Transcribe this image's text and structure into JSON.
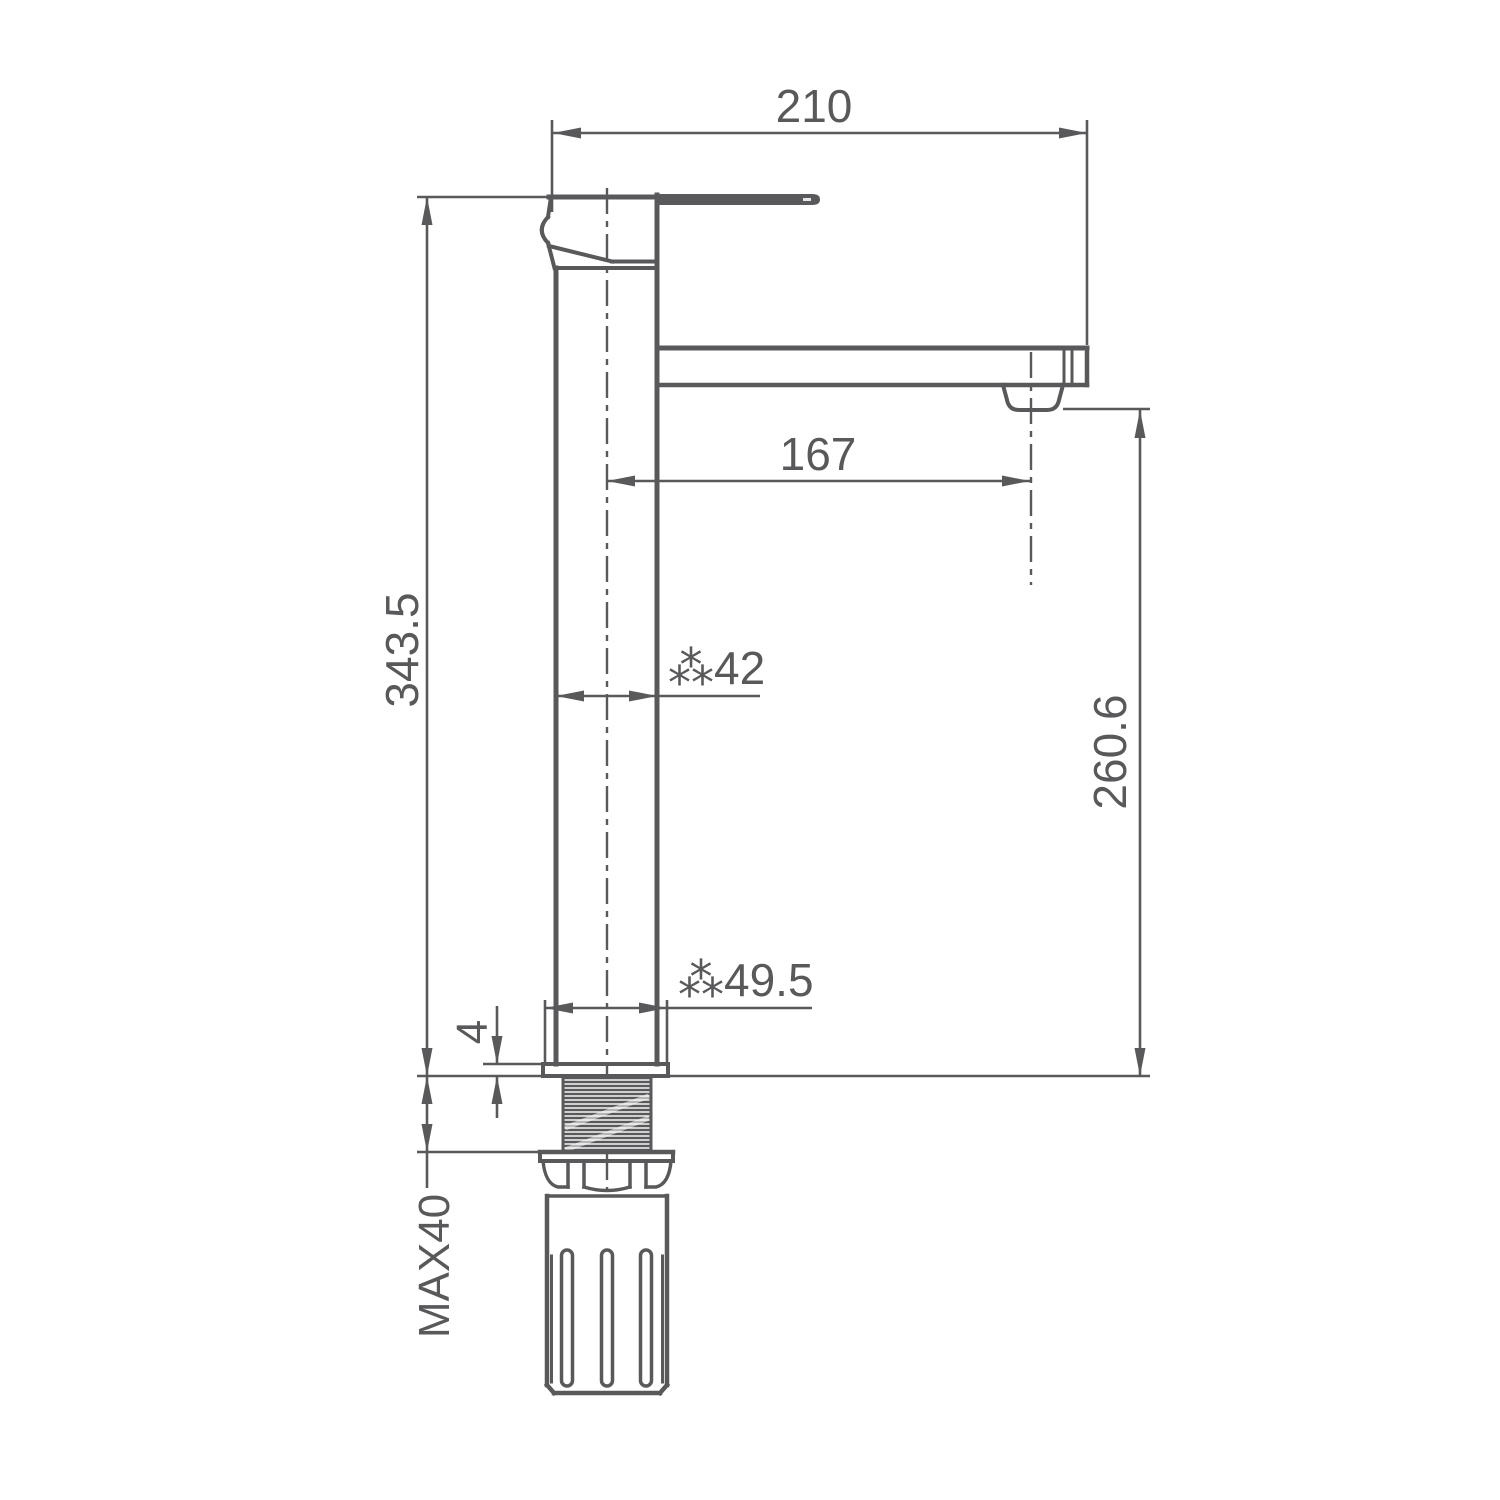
{
  "drawing": {
    "description": "faucet-technical-dimension-drawing",
    "colors": {
      "line": "#59595c",
      "background": "#ffffff"
    },
    "dimensions": {
      "top_width": {
        "label": "210"
      },
      "spout_reach": {
        "label": "167"
      },
      "total_height": {
        "label": "343.5"
      },
      "spout_outlet_height": {
        "label": "260.6"
      },
      "body_diameter": {
        "label": "⁂42"
      },
      "base_diameter": {
        "label": "⁂49.5"
      },
      "base_plate_thickness": {
        "label": "4"
      },
      "max_deck_thickness": {
        "label": "MAX40"
      }
    }
  }
}
